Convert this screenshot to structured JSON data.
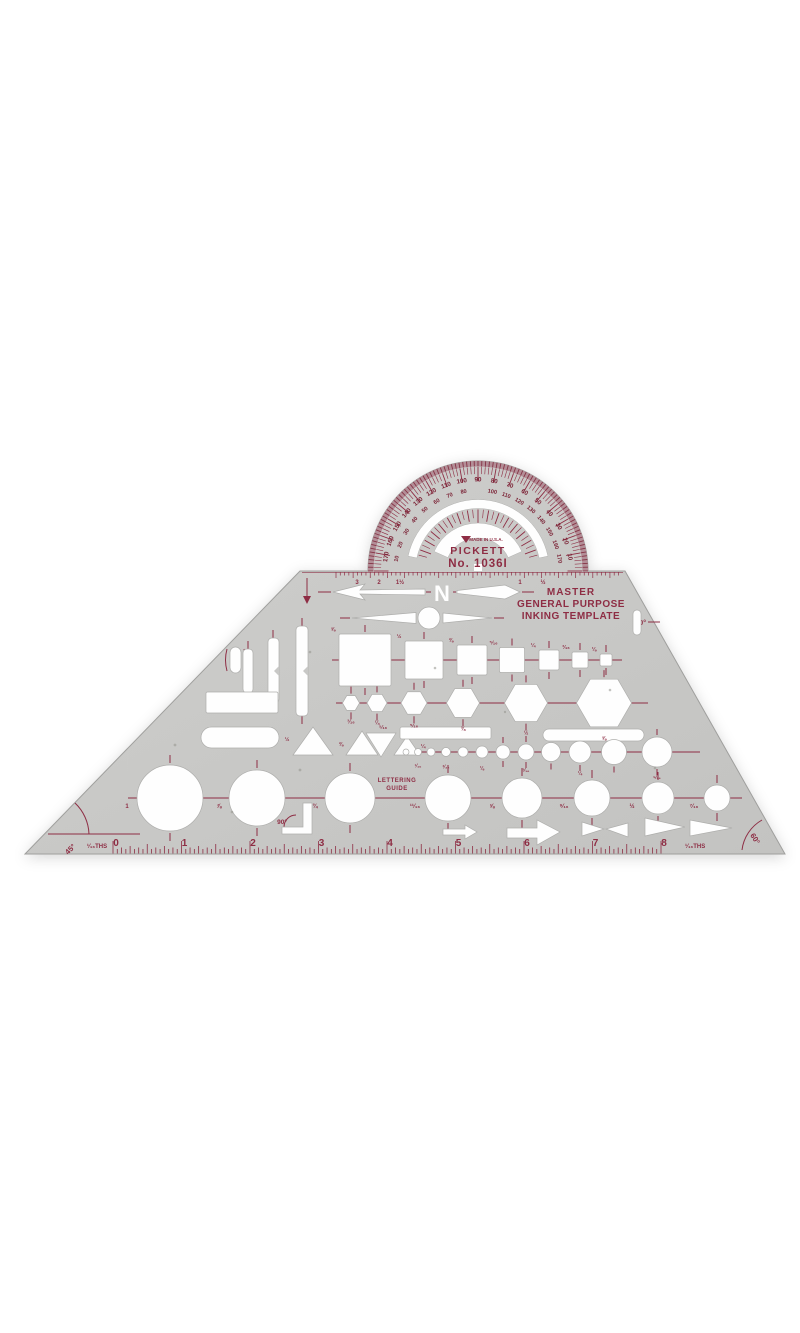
{
  "product": {
    "brand": "PICKETT",
    "made_in": "MADE IN U.S.A.",
    "model": "No. 1036I",
    "title_line1": "MASTER",
    "title_line2": "GENERAL PURPOSE",
    "title_line3": "INKING TEMPLATE",
    "lettering_guide_line1": "LETTERING",
    "lettering_guide_line2": "GUIDE",
    "north_letter": "N"
  },
  "colors": {
    "body": "#c8c8c6",
    "body_light": "#cfcfcd",
    "print": "#8e2d44",
    "print_dark": "#7c2437",
    "rim": "#b38e97",
    "edge": "#9f9f9d",
    "cutout": "#fefefe"
  },
  "angles": {
    "left": "45°",
    "corner": "90°",
    "right_edge": "30°",
    "bottom_right": "60°"
  },
  "protractor": {
    "cx": 478,
    "cy": 571,
    "pairs": [
      {
        "t": 10,
        "o": "10",
        "i": "170"
      },
      {
        "t": 20,
        "o": "20",
        "i": "160"
      },
      {
        "t": 30,
        "o": "30",
        "i": "150"
      },
      {
        "t": 40,
        "o": "40",
        "i": "140"
      },
      {
        "t": 50,
        "o": "50",
        "i": "130"
      },
      {
        "t": 60,
        "o": "60",
        "i": "120"
      },
      {
        "t": 70,
        "o": "70",
        "i": "110"
      },
      {
        "t": 80,
        "o": "80",
        "i": "100"
      },
      {
        "t": 90,
        "o": "90",
        "i": ""
      },
      {
        "t": 100,
        "o": "100",
        "i": "80"
      },
      {
        "t": 110,
        "o": "110",
        "i": "70"
      },
      {
        "t": 120,
        "o": "120",
        "i": "60"
      },
      {
        "t": 130,
        "o": "130",
        "i": "50"
      },
      {
        "t": 140,
        "o": "140",
        "i": "40"
      },
      {
        "t": 150,
        "o": "150",
        "i": "30"
      },
      {
        "t": 160,
        "o": "160",
        "i": "20"
      },
      {
        "t": 170,
        "o": "170",
        "i": "10"
      }
    ]
  },
  "ruler": {
    "x0": 113,
    "ppi": 68.5,
    "baseline": 854,
    "numbers": [
      "0",
      "1",
      "2",
      "3",
      "4",
      "5",
      "6",
      "7",
      "8"
    ],
    "left_units": "¹⁄₁₆THS",
    "right_units": "¹⁄₁₆THS"
  },
  "top_edge": {
    "labels": [
      {
        "x": 357,
        "t": "3"
      },
      {
        "x": 379,
        "t": "2"
      },
      {
        "x": 400,
        "t": "1½"
      },
      {
        "x": 520,
        "t": "1"
      },
      {
        "x": 543,
        "t": "½"
      }
    ]
  },
  "shapes": {
    "squares": {
      "y": 660,
      "cx": [
        365,
        424,
        472,
        512,
        549,
        580,
        606
      ],
      "size": [
        52,
        38,
        30,
        25,
        20,
        16,
        12
      ],
      "labels": [
        "⅝",
        "½",
        "⅜",
        "⁵⁄₁₆",
        "¼",
        "³⁄₁₆",
        "⅛"
      ]
    },
    "hexagons": {
      "cy": 703,
      "cx": [
        351,
        377,
        414,
        463,
        526,
        604
      ],
      "size": [
        17,
        20,
        26,
        33,
        43,
        55
      ],
      "labels": [
        "³⁄₁₆",
        "¼",
        "⁵⁄₁₆",
        "⅜",
        "½",
        "⅝"
      ]
    },
    "small_circles": {
      "cy": 752,
      "cx": [
        406,
        418,
        431,
        446,
        463,
        482,
        503,
        526,
        551,
        580,
        614,
        657
      ],
      "r": [
        3,
        3.5,
        4,
        4.5,
        5,
        6,
        7,
        8,
        9.5,
        11,
        12.5,
        15
      ],
      "labels": [
        "",
        "¹⁄₁₆",
        "",
        "³⁄₃₂",
        "",
        "⅛",
        "",
        "³⁄₁₆",
        "",
        "¼",
        "",
        "⁵⁄₁₆"
      ]
    },
    "big_circles": {
      "cy": 798,
      "cx": [
        170,
        257,
        350,
        448,
        522,
        592,
        658,
        717
      ],
      "r": [
        33,
        28,
        25,
        23,
        20,
        18,
        16,
        13
      ],
      "labels": [
        "1",
        "⅞",
        "¾",
        "¹¹⁄₁₆",
        "⅝",
        "⁹⁄₁₆",
        "½",
        "⁷⁄₁₆"
      ]
    },
    "triangle_labels": [
      {
        "x": 287,
        "y": 741,
        "t": "½"
      },
      {
        "x": 341,
        "y": 746,
        "t": "⅜"
      },
      {
        "x": 383,
        "y": 729,
        "t": "⁵⁄₁₆"
      },
      {
        "x": 423,
        "y": 748,
        "t": "¼"
      }
    ]
  }
}
